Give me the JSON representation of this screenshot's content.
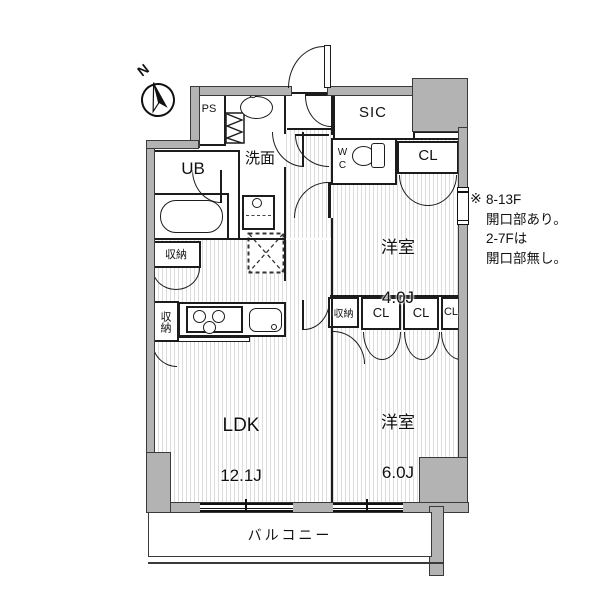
{
  "colors": {
    "wall_fill": "#b3b3b3",
    "line": "#1c1c1c",
    "floor_stripe": "#dcdcdc"
  },
  "compass": {
    "label": "N"
  },
  "rooms": {
    "ldk": {
      "name": "LDK",
      "size": "12.1J"
    },
    "room4": {
      "name": "洋室",
      "size": "4.0J"
    },
    "room6": {
      "name": "洋室",
      "size": "6.0J"
    },
    "ub": "UB",
    "senmen": "洗面",
    "wc": "WC",
    "sic": "SIC",
    "ps": "PS",
    "cl_top": "CL",
    "cl_a": "CL",
    "cl_b": "CL",
    "cl_c": "CL",
    "shuno_bath": "収納",
    "shuno_mid": "収納",
    "shuno_kitchen": "収納",
    "balcony": "バルコニー"
  },
  "annotation": {
    "marker": "※",
    "text": "8-13F\n開口部あり。\n2-7Fは\n開口部無し。"
  }
}
